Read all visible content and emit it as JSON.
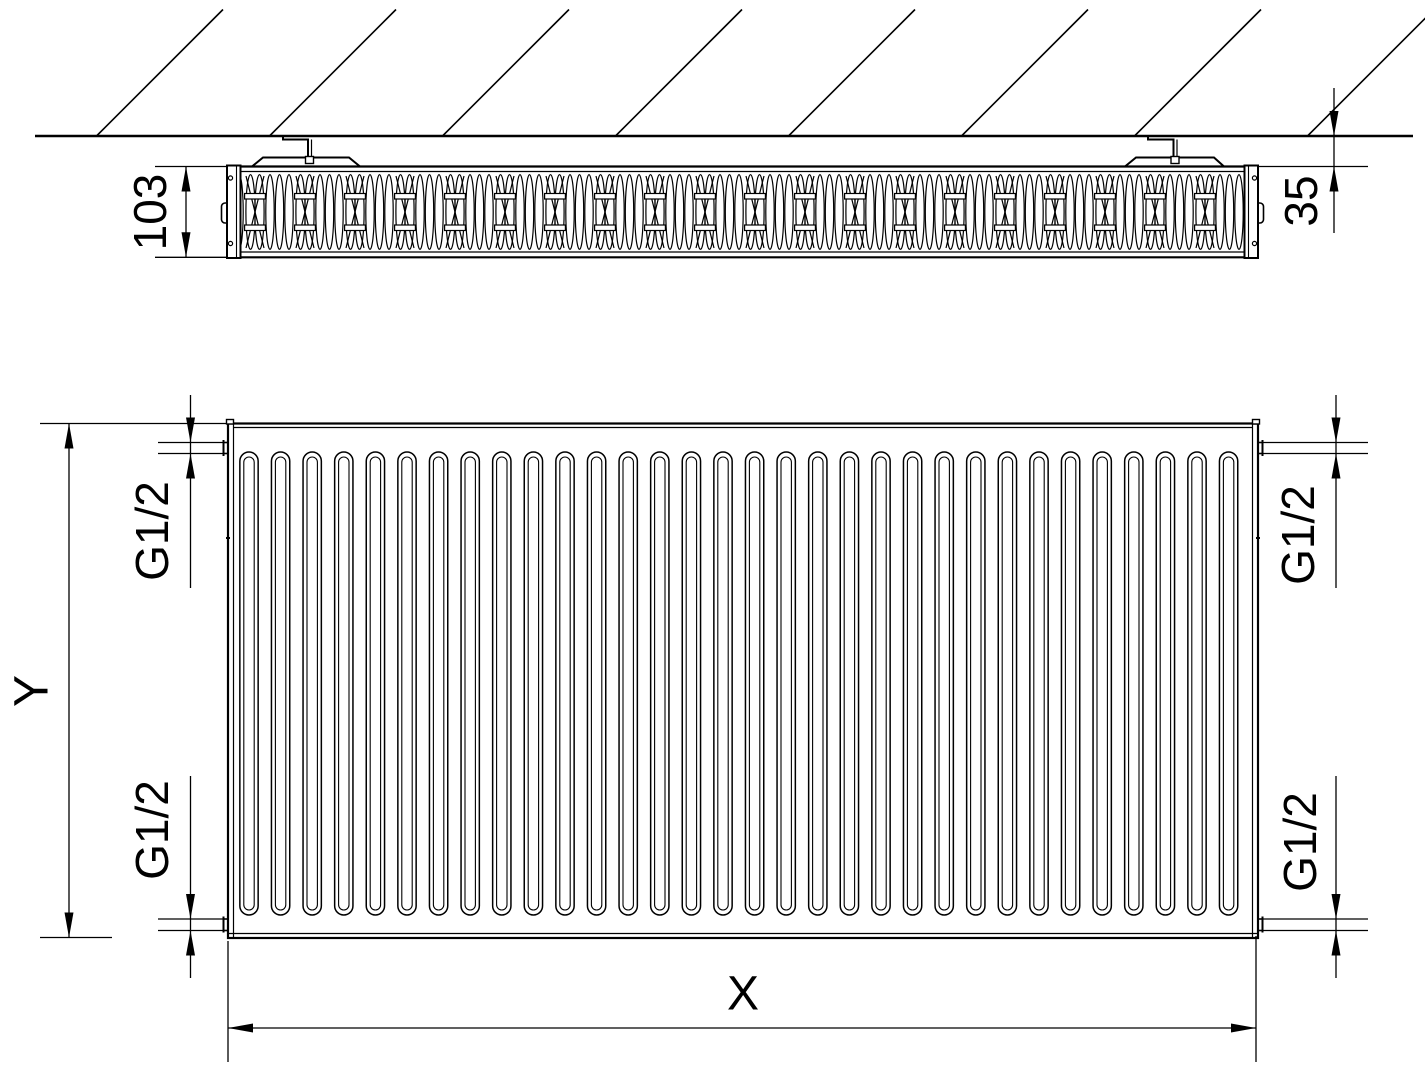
{
  "drawing_labels": {
    "depth_mm": "103",
    "wall_distance_mm": "35",
    "height": "Y",
    "width": "X",
    "connection_top_left": "G1/2",
    "connection_bottom_left": "G1/2",
    "connection_top_right": "G1/2",
    "connection_bottom_right": "G1/2"
  },
  "colors": {
    "line": "#000000",
    "background": "#ffffff"
  }
}
